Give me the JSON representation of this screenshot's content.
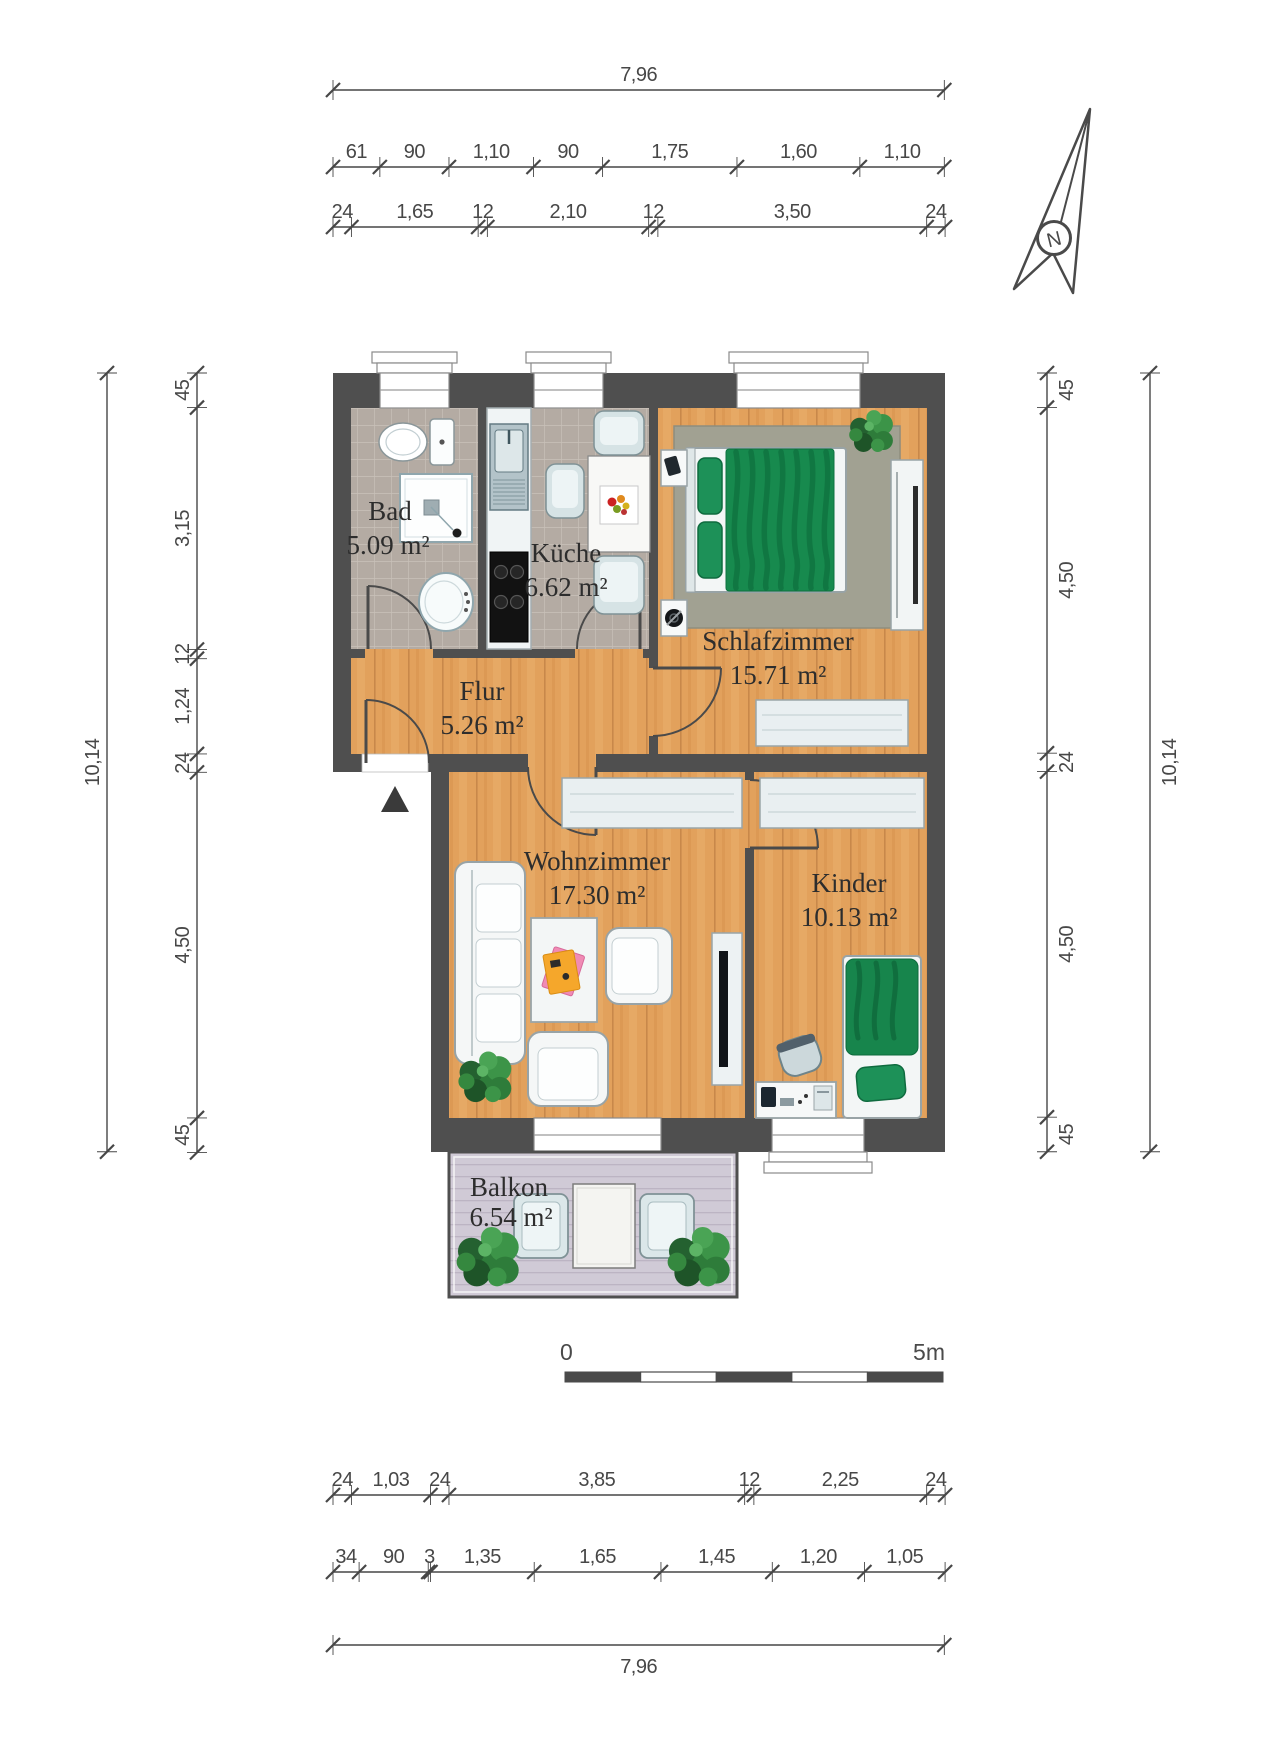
{
  "compass": {
    "label": "N"
  },
  "scalebar": {
    "start": "0",
    "end": "5m"
  },
  "rooms": {
    "bad": {
      "name": "Bad",
      "area": "5.09 m²"
    },
    "kueche": {
      "name": "Küche",
      "area": "6.62 m²"
    },
    "schlafzimmer": {
      "name": "Schlafzimmer",
      "area": "15.71 m²"
    },
    "flur": {
      "name": "Flur",
      "area": "5.26 m²"
    },
    "wohnzimmer": {
      "name": "Wohnzimmer",
      "area": "17.30 m²"
    },
    "kinder": {
      "name": "Kinder",
      "area": "10.13 m²"
    },
    "balkon": {
      "name": "Balkon",
      "area": "6.54 m²"
    }
  },
  "dimensions": {
    "px_per_m": 76.8,
    "chains": [
      {
        "name": "top-overall",
        "dir": "h",
        "x0": 333,
        "y": 90,
        "side": "above",
        "segments": [
          {
            "v": 7.96,
            "label": "7,96"
          }
        ]
      },
      {
        "name": "top-openings",
        "dir": "h",
        "x0": 333,
        "y": 167,
        "side": "above",
        "segments": [
          {
            "v": 0.61,
            "label": "61"
          },
          {
            "v": 0.9,
            "label": "90"
          },
          {
            "v": 1.1,
            "label": "1,10"
          },
          {
            "v": 0.9,
            "label": "90"
          },
          {
            "v": 1.75,
            "label": "1,75"
          },
          {
            "v": 1.6,
            "label": "1,60"
          },
          {
            "v": 1.1,
            "label": "1,10"
          }
        ]
      },
      {
        "name": "top-walls",
        "dir": "h",
        "x0": 333,
        "y": 227,
        "side": "above",
        "segments": [
          {
            "v": 0.24,
            "label": "24"
          },
          {
            "v": 1.65,
            "label": "1,65"
          },
          {
            "v": 0.12,
            "label": "12"
          },
          {
            "v": 2.1,
            "label": "2,10"
          },
          {
            "v": 0.12,
            "label": "12"
          },
          {
            "v": 3.5,
            "label": "3,50"
          },
          {
            "v": 0.24,
            "label": "24"
          }
        ]
      },
      {
        "name": "left-rooms",
        "dir": "v",
        "y0": 373,
        "x": 197,
        "side": "left",
        "segments": [
          {
            "v": 0.45,
            "label": "45"
          },
          {
            "v": 3.15,
            "label": "3,15"
          },
          {
            "v": 0.12,
            "label": "12"
          },
          {
            "v": 1.24,
            "label": "1,24"
          },
          {
            "v": 0.24,
            "label": "24"
          },
          {
            "v": 4.5,
            "label": "4,50"
          },
          {
            "v": 0.45,
            "label": "45"
          }
        ]
      },
      {
        "name": "left-overall",
        "dir": "v",
        "y0": 373,
        "x": 107,
        "side": "left",
        "segments": [
          {
            "v": 10.14,
            "label": "10,14"
          }
        ]
      },
      {
        "name": "right-rooms",
        "dir": "v",
        "y0": 373,
        "x": 1047,
        "side": "right",
        "segments": [
          {
            "v": 0.45,
            "label": "45"
          },
          {
            "v": 4.5,
            "label": "4,50"
          },
          {
            "v": 0.24,
            "label": "24"
          },
          {
            "v": 4.5,
            "label": "4,50"
          },
          {
            "v": 0.45,
            "label": "45"
          }
        ]
      },
      {
        "name": "right-overall",
        "dir": "v",
        "y0": 373,
        "x": 1150,
        "side": "right",
        "segments": [
          {
            "v": 10.14,
            "label": "10,14"
          }
        ]
      },
      {
        "name": "bottom-walls",
        "dir": "h",
        "x0": 333,
        "y": 1495,
        "side": "above",
        "segments": [
          {
            "v": 0.24,
            "label": "24"
          },
          {
            "v": 1.03,
            "label": "1,03"
          },
          {
            "v": 0.24,
            "label": "24"
          },
          {
            "v": 3.85,
            "label": "3,85"
          },
          {
            "v": 0.12,
            "label": "12"
          },
          {
            "v": 2.25,
            "label": "2,25"
          },
          {
            "v": 0.24,
            "label": "24"
          }
        ]
      },
      {
        "name": "bottom-openings",
        "dir": "h",
        "x0": 333,
        "y": 1572,
        "side": "above",
        "segments": [
          {
            "v": 0.34,
            "label": "34"
          },
          {
            "v": 0.9,
            "label": "90"
          },
          {
            "v": 0.03,
            "label": "3"
          },
          {
            "v": 1.35,
            "label": "1,35"
          },
          {
            "v": 1.65,
            "label": "1,65"
          },
          {
            "v": 1.45,
            "label": "1,45"
          },
          {
            "v": 1.2,
            "label": "1,20"
          },
          {
            "v": 1.05,
            "label": "1,05"
          }
        ]
      },
      {
        "name": "bottom-overall",
        "dir": "h",
        "x0": 333,
        "y": 1645,
        "side": "below",
        "segments": [
          {
            "v": 7.96,
            "label": "7,96"
          }
        ]
      }
    ]
  }
}
